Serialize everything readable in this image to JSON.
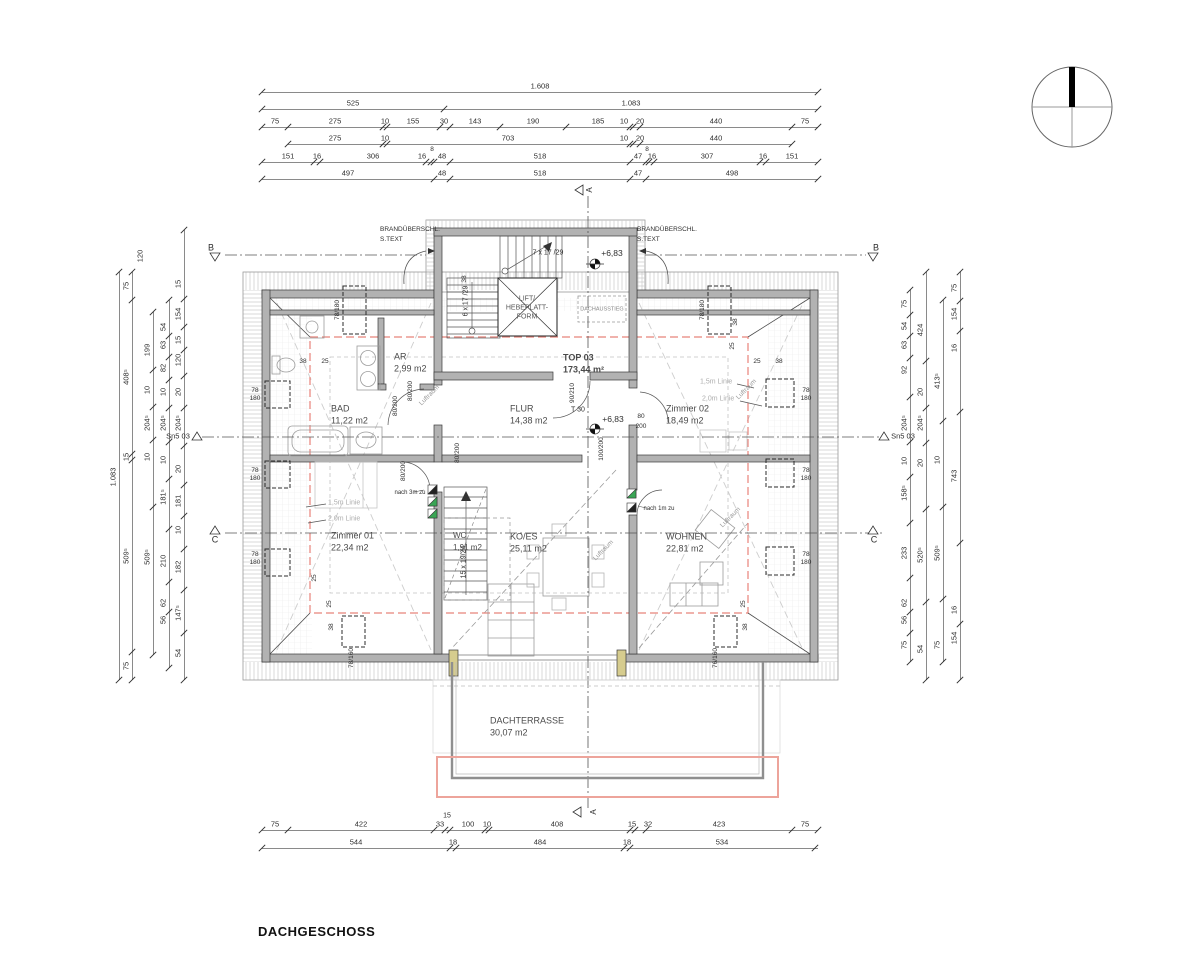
{
  "title": "DACHGESCHOSS",
  "colors": {
    "wall": "#b2b2b2",
    "line_dark": "#2f2f2f",
    "line_mid": "#8a8a8a",
    "red_dashed_line": "#e8837a",
    "terrace_red_line": "#eda49b",
    "green_vent": "#3aa655",
    "jamb_yellow": "#d6cc8e"
  },
  "compass": {
    "name": "north-arrow"
  },
  "section_markers": [
    {
      "label": "B",
      "side": "left"
    },
    {
      "label": "B",
      "side": "right"
    },
    {
      "label": "C",
      "side": "left"
    },
    {
      "label": "C",
      "side": "right"
    },
    {
      "label": "Sn5 03",
      "side": "left"
    },
    {
      "label": "Sn5 03",
      "side": "right"
    },
    {
      "label": "A",
      "side": "top"
    },
    {
      "label": "A",
      "side": "bottom"
    }
  ],
  "room_labels": [
    {
      "n": "bad",
      "t": "BAD",
      "area": "11,22 m2",
      "x": 331,
      "y": 409
    },
    {
      "n": "ar",
      "t": "AR",
      "area": "2,99 m2",
      "x": 394,
      "y": 357
    },
    {
      "n": "flur",
      "t": "FLUR",
      "area": "14,38 m2",
      "x": 510,
      "y": 409
    },
    {
      "n": "top-03",
      "t": "TOP 03",
      "area": "173,44 m²",
      "x": 563,
      "y": 358,
      "b": 1
    },
    {
      "n": "zimmer-02",
      "t": "Zimmer 02",
      "area": "18,49 m2",
      "x": 666,
      "y": 409
    },
    {
      "n": "zimmer-01",
      "t": "Zimmer 01",
      "area": "22,34 m2",
      "x": 331,
      "y": 536
    },
    {
      "n": "wc",
      "t": "WC",
      "area": "1,91 m2",
      "x": 453,
      "y": 536,
      "s": 8
    },
    {
      "n": "ko-es",
      "t": "KO/ES",
      "area": "25,11 m2",
      "x": 510,
      "y": 537
    },
    {
      "n": "wohnen",
      "t": "WOHNEN",
      "area": "22,81 m2",
      "x": 666,
      "y": 537
    },
    {
      "n": "dachterrasse",
      "t": "DACHTERRASSE",
      "area": "30,07 m2",
      "x": 490,
      "y": 721
    }
  ],
  "dim_chains": [
    {
      "o": "h",
      "pos": 92,
      "from": 262,
      "to": 818,
      "ticks": [
        262,
        818
      ],
      "labels": [
        [
          "1.608",
          540
        ]
      ]
    },
    {
      "o": "h",
      "pos": 109,
      "from": 262,
      "to": 818,
      "ticks": [
        262,
        444,
        818
      ],
      "labels": [
        [
          "525",
          353
        ],
        [
          "1.083",
          631
        ]
      ]
    },
    {
      "o": "h",
      "pos": 127,
      "from": 262,
      "to": 818,
      "ticks": [
        262,
        288,
        383,
        387,
        440,
        450,
        500,
        566,
        630,
        633,
        640,
        792,
        818
      ],
      "labels": [
        [
          "75",
          275
        ],
        [
          "275",
          335
        ],
        [
          "10",
          385
        ],
        [
          "155",
          413
        ],
        [
          "30",
          444
        ],
        [
          "143",
          475
        ],
        [
          "190",
          533
        ],
        [
          "185",
          598
        ],
        [
          "10",
          624
        ],
        [
          "20",
          640
        ],
        [
          "440",
          716
        ],
        [
          "75",
          805
        ]
      ]
    },
    {
      "o": "h",
      "pos": 144,
      "from": 288,
      "to": 792,
      "ticks": [
        288,
        383,
        387,
        630,
        633,
        640,
        792
      ],
      "labels": [
        [
          "275",
          335
        ],
        [
          "10",
          385
        ],
        [
          "703",
          508
        ],
        [
          "10",
          624
        ],
        [
          "20",
          640
        ],
        [
          "440",
          716
        ]
      ]
    },
    {
      "o": "h",
      "pos": 162,
      "from": 262,
      "to": 818,
      "ticks": [
        262,
        314,
        320,
        426,
        431,
        434,
        450,
        630,
        646,
        649,
        654,
        760,
        766,
        818
      ],
      "labels": [
        [
          "151",
          288
        ],
        [
          "16",
          317
        ],
        [
          "306",
          373
        ],
        [
          "16",
          422
        ],
        [
          "48",
          442
        ],
        [
          "518",
          540
        ],
        [
          "47",
          638
        ],
        [
          "16",
          652
        ],
        [
          "307",
          707
        ],
        [
          "16",
          763
        ],
        [
          "151",
          792
        ]
      ]
    },
    {
      "o": "h",
      "pos": 179,
      "from": 262,
      "to": 818,
      "ticks": [
        262,
        434,
        450,
        630,
        646,
        818
      ],
      "labels": [
        [
          "497",
          348
        ],
        [
          "48",
          442
        ],
        [
          "518",
          540
        ],
        [
          "47",
          638
        ],
        [
          "498",
          732
        ]
      ]
    },
    {
      "o": "h",
      "pos": 830,
      "from": 262,
      "to": 818,
      "ticks": [
        262,
        288,
        434,
        445,
        450,
        485,
        489,
        630,
        635,
        646,
        792,
        818
      ],
      "labels": [
        [
          "75",
          275
        ],
        [
          "422",
          361
        ],
        [
          "33",
          440
        ],
        [
          "100",
          468
        ],
        [
          "10",
          487
        ],
        [
          "408",
          557
        ],
        [
          "15",
          632
        ],
        [
          "32",
          648
        ],
        [
          "423",
          719
        ],
        [
          "75",
          805
        ]
      ]
    },
    {
      "o": "h",
      "pos": 848,
      "from": 262,
      "to": 818,
      "ticks": [
        262,
        450,
        456,
        624,
        630,
        815
      ],
      "labels": [
        [
          "544",
          356
        ],
        [
          "18",
          453
        ],
        [
          "484",
          540
        ],
        [
          "18",
          627
        ],
        [
          "534",
          722
        ]
      ]
    },
    {
      "o": "v",
      "pos": 119,
      "from": 272,
      "to": 680,
      "ticks": [
        272,
        680
      ],
      "labels": [
        [
          "1.083",
          477
        ]
      ]
    },
    {
      "o": "v",
      "pos": 132,
      "from": 272,
      "to": 680,
      "ticks": [
        272,
        300,
        454,
        460,
        652,
        680
      ],
      "labels": [
        [
          "75",
          286
        ],
        [
          "408⁵",
          377
        ],
        [
          "15",
          457
        ],
        [
          "509⁵",
          556
        ],
        [
          "75",
          666
        ]
      ]
    },
    {
      "o": "v",
      "pos": 153,
      "from": 312,
      "to": 655,
      "labels": [
        [
          "199",
          350
        ],
        [
          "10",
          390
        ],
        [
          "204⁵",
          423
        ],
        [
          "10",
          457
        ],
        [
          "509⁵",
          557
        ]
      ]
    },
    {
      "o": "v",
      "pos": 169,
      "from": 300,
      "to": 668,
      "labels": [
        [
          "54",
          327
        ],
        [
          "63",
          345
        ],
        [
          "82",
          368
        ],
        [
          "10",
          392
        ],
        [
          "204⁵",
          423
        ],
        [
          "10",
          460
        ],
        [
          "181⁵",
          497
        ],
        [
          "210",
          561
        ],
        [
          "62",
          603
        ],
        [
          "56",
          620
        ]
      ]
    },
    {
      "o": "v",
      "pos": 184,
      "from": 230,
      "to": 680,
      "labels": [
        [
          "15",
          284
        ],
        [
          "154",
          314
        ],
        [
          "15",
          340
        ],
        [
          "120",
          360
        ],
        [
          "20",
          392
        ],
        [
          "204⁵",
          423
        ],
        [
          "20",
          469
        ],
        [
          "181",
          501
        ],
        [
          "10",
          530
        ],
        [
          "182",
          567
        ],
        [
          "147⁵",
          613
        ],
        [
          "54",
          653
        ]
      ]
    },
    {
      "o": "v",
      "pos": 910,
      "from": 290,
      "to": 662,
      "labels": [
        [
          "75",
          304
        ],
        [
          "54",
          326
        ],
        [
          "63",
          345
        ],
        [
          "92",
          370
        ],
        [
          "204⁵",
          423
        ],
        [
          "10",
          461
        ],
        [
          "158⁵",
          493
        ],
        [
          "233",
          553
        ],
        [
          "62",
          603
        ],
        [
          "56",
          620
        ],
        [
          "75",
          645
        ]
      ]
    },
    {
      "o": "v",
      "pos": 926,
      "from": 272,
      "to": 680,
      "labels": [
        [
          "424",
          330
        ],
        [
          "20",
          392
        ],
        [
          "204⁵",
          423
        ],
        [
          "20",
          463
        ],
        [
          "520⁵",
          555
        ],
        [
          "54",
          649
        ]
      ]
    },
    {
      "o": "v",
      "pos": 943,
      "from": 300,
      "to": 662,
      "labels": [
        [
          "413⁵",
          381
        ],
        [
          "10",
          460
        ],
        [
          "509⁵",
          553
        ],
        [
          "75",
          645
        ]
      ]
    },
    {
      "o": "v",
      "pos": 960,
      "from": 272,
      "to": 680,
      "labels": [
        [
          "75",
          288
        ],
        [
          "154",
          314
        ],
        [
          "16",
          348
        ],
        [
          "743",
          476
        ],
        [
          "16",
          610
        ],
        [
          "154",
          638
        ]
      ]
    }
  ],
  "annotations": [
    {
      "t": "8",
      "x": 432,
      "y": 150,
      "s": 6.5
    },
    {
      "t": "8",
      "x": 647,
      "y": 150,
      "s": 6.5
    },
    {
      "t": "15",
      "x": 447,
      "y": 816,
      "s": 7
    },
    {
      "t": "120",
      "x": 140,
      "y": 256,
      "r": 90,
      "s": 7.5
    },
    {
      "t": "B",
      "x": 211,
      "y": 248,
      "s": 9
    },
    {
      "t": "B",
      "x": 876,
      "y": 248,
      "s": 9
    },
    {
      "t": "C",
      "x": 215,
      "y": 540,
      "s": 9
    },
    {
      "t": "C",
      "x": 874,
      "y": 540,
      "s": 9
    },
    {
      "t": "Sn5 03",
      "x": 178,
      "y": 436,
      "s": 7.5
    },
    {
      "t": "Sn5 03",
      "x": 903,
      "y": 436,
      "s": 7.5
    },
    {
      "t": "A",
      "x": 590,
      "y": 190,
      "r": 90,
      "s": 8
    },
    {
      "t": "A",
      "x": 594,
      "y": 812,
      "r": 90,
      "s": 8
    },
    {
      "t": "BRANDÜBERSCHL.",
      "x": 380,
      "y": 230,
      "s": 6.5,
      "a": "l"
    },
    {
      "t": "S.TEXT",
      "x": 380,
      "y": 240,
      "s": 6.5,
      "a": "l"
    },
    {
      "t": "BRANDÜBERSCHL.",
      "x": 637,
      "y": 230,
      "s": 6.5,
      "a": "l"
    },
    {
      "t": "S.TEXT",
      "x": 637,
      "y": 240,
      "s": 6.5,
      "a": "l"
    },
    {
      "t": "7 x 17 /29",
      "x": 548,
      "y": 253,
      "s": 7
    },
    {
      "t": "6 x 17 /29",
      "x": 466,
      "y": 301,
      "r": 90,
      "s": 7
    },
    {
      "t": "15 x 19/24",
      "x": 464,
      "y": 562,
      "r": 90,
      "s": 7
    },
    {
      "t": "+6,83",
      "x": 612,
      "y": 253,
      "s": 8.5
    },
    {
      "t": "+6,83",
      "x": 613,
      "y": 419,
      "s": 8.5
    },
    {
      "t": "LIFT/",
      "x": 527,
      "y": 299,
      "s": 7,
      "c": "#555"
    },
    {
      "t": "HEBEPLATT-",
      "x": 527,
      "y": 308,
      "s": 7,
      "c": "#555"
    },
    {
      "t": "FORM",
      "x": 527,
      "y": 317,
      "s": 7,
      "c": "#555"
    },
    {
      "t": "DACHAUSSTIEG",
      "x": 602,
      "y": 310,
      "s": 5.5,
      "c": "#888"
    },
    {
      "t": "T 30",
      "x": 578,
      "y": 410,
      "s": 7
    },
    {
      "t": "90/210",
      "x": 573,
      "y": 393,
      "r": 90,
      "s": 6.5
    },
    {
      "t": "100/200",
      "x": 602,
      "y": 449,
      "r": 90,
      "s": 6.5
    },
    {
      "t": "80/200",
      "x": 396,
      "y": 406,
      "r": 90,
      "s": 6.5
    },
    {
      "t": "80/200",
      "x": 411,
      "y": 391,
      "r": 90,
      "s": 6.5
    },
    {
      "t": "80/200",
      "x": 458,
      "y": 453,
      "r": 90,
      "s": 6.5
    },
    {
      "t": "80/200",
      "x": 404,
      "y": 471,
      "r": 90,
      "s": 6.5
    },
    {
      "t": "80",
      "x": 641,
      "y": 417,
      "s": 6.5
    },
    {
      "t": "200",
      "x": 641,
      "y": 427,
      "s": 6.5
    },
    {
      "t": "nach 3m zu",
      "x": 410,
      "y": 493,
      "s": 6
    },
    {
      "t": "nach 1m zu",
      "x": 659,
      "y": 509,
      "s": 6
    },
    {
      "t": "Luftraum",
      "x": 430,
      "y": 396,
      "r": 45,
      "s": 6.5,
      "c": "#9a9a9a"
    },
    {
      "t": "Luftraum",
      "x": 747,
      "y": 390,
      "r": 45,
      "s": 6.5,
      "c": "#9a9a9a"
    },
    {
      "t": "Luftraum",
      "x": 604,
      "y": 551,
      "r": 45,
      "s": 6.5,
      "c": "#9a9a9a"
    },
    {
      "t": "Luftraum",
      "x": 731,
      "y": 518,
      "r": 45,
      "s": 6.5,
      "c": "#9a9a9a"
    },
    {
      "t": "1,5m Linie",
      "x": 328,
      "y": 503,
      "s": 7,
      "c": "#adadad",
      "a": "l"
    },
    {
      "t": "2,0m Linie",
      "x": 328,
      "y": 519,
      "s": 7,
      "c": "#adadad",
      "a": "l"
    },
    {
      "t": "1,5m Linie",
      "x": 700,
      "y": 382,
      "s": 7,
      "c": "#adadad",
      "a": "l"
    },
    {
      "t": "2,0m Linie",
      "x": 702,
      "y": 399,
      "s": 7,
      "c": "#adadad",
      "a": "l"
    },
    {
      "t": "78/180",
      "x": 338,
      "y": 310,
      "r": 90,
      "s": 6.5
    },
    {
      "t": "78/180",
      "x": 703,
      "y": 310,
      "r": 90,
      "s": 6.5
    },
    {
      "t": "78",
      "x": 255,
      "y": 391,
      "s": 6.5
    },
    {
      "t": "180",
      "x": 255,
      "y": 399,
      "s": 6.5
    },
    {
      "t": "78",
      "x": 255,
      "y": 471,
      "s": 6.5
    },
    {
      "t": "180",
      "x": 255,
      "y": 479,
      "s": 6.5
    },
    {
      "t": "78",
      "x": 255,
      "y": 555,
      "s": 6.5
    },
    {
      "t": "180",
      "x": 255,
      "y": 563,
      "s": 6.5
    },
    {
      "t": "78",
      "x": 806,
      "y": 391,
      "s": 6.5
    },
    {
      "t": "180",
      "x": 806,
      "y": 399,
      "s": 6.5
    },
    {
      "t": "78",
      "x": 806,
      "y": 471,
      "s": 6.5
    },
    {
      "t": "180",
      "x": 806,
      "y": 479,
      "s": 6.5
    },
    {
      "t": "78",
      "x": 806,
      "y": 555,
      "s": 6.5
    },
    {
      "t": "180",
      "x": 806,
      "y": 563,
      "s": 6.5
    },
    {
      "t": "78/160",
      "x": 352,
      "y": 658,
      "r": 90,
      "s": 6.5
    },
    {
      "t": "76/160",
      "x": 716,
      "y": 658,
      "r": 90,
      "s": 6.5
    },
    {
      "t": "25",
      "x": 330,
      "y": 604,
      "r": 90,
      "s": 6.5
    },
    {
      "t": "38",
      "x": 332,
      "y": 627,
      "r": 90,
      "s": 6.5
    },
    {
      "t": "25",
      "x": 315,
      "y": 578,
      "r": 90,
      "s": 6.5
    },
    {
      "t": "25",
      "x": 744,
      "y": 604,
      "r": 90,
      "s": 6.5
    },
    {
      "t": "38",
      "x": 746,
      "y": 627,
      "r": 90,
      "s": 6.5
    },
    {
      "t": "38",
      "x": 303,
      "y": 362,
      "s": 6.5
    },
    {
      "t": "25",
      "x": 325,
      "y": 362,
      "s": 6.5
    },
    {
      "t": "25",
      "x": 757,
      "y": 362,
      "s": 6.5
    },
    {
      "t": "38",
      "x": 779,
      "y": 362,
      "s": 6.5
    },
    {
      "t": "38",
      "x": 465,
      "y": 279,
      "r": 90,
      "s": 6.5
    },
    {
      "t": "38",
      "x": 736,
      "y": 322,
      "r": 90,
      "s": 6.5
    },
    {
      "t": "25",
      "x": 733,
      "y": 346,
      "r": 90,
      "s": 6.5
    }
  ]
}
